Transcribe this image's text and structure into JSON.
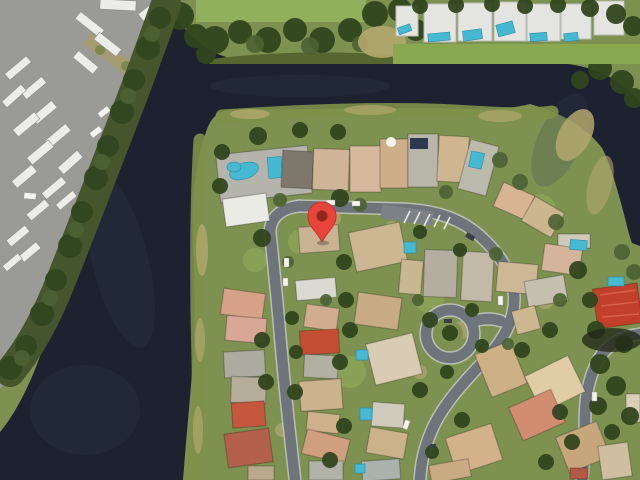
{
  "scene": {
    "type": "satellite-aerial-view",
    "description": "Google-Maps style satellite screenshot of a waterfront residential neighborhood. A dark canal wraps from the lower-left up across the top. A bus/RV parking lot fills the top-left corner, a row of white condo buildings with small pools lines the top-right, and single-family homes with gray, tan and red roofs sit along curving streets with a cul-de-sac loop. A red location pin marks a house near the center.",
    "visible_text": "none"
  },
  "marker": {
    "name": "location-pin",
    "tip_x_pct": 50.2,
    "tip_y_pct": 50.0,
    "body_color": "#e8443b",
    "dot_color": "#8e2a1c"
  },
  "palette": {
    "water": "#1c2230",
    "water_highlight": "#39445c",
    "grass": "#7d9150",
    "grass_bright": "#92b05c",
    "trees_dark": "#32461f",
    "trees_mid": "#4c6233",
    "bank_tan": "#b3a76d",
    "road": "#6e747b",
    "curb": "#c3c7c6",
    "parking_asphalt": "#9a9b97",
    "vehicle_white": "#ecedea",
    "roof_gray": "#b8b5a9",
    "roof_tan": "#cdb18a",
    "roof_red": "#c23f2c",
    "pool": "#45b9d2",
    "condo_white": "#e4e5e1"
  },
  "regions": [
    {
      "name": "parking-lot",
      "label": "bus and RV parking lot"
    },
    {
      "name": "canal-water",
      "label": "dark canal / lake water"
    },
    {
      "name": "tree-line",
      "label": "tree line along water"
    },
    {
      "name": "condo-row",
      "label": "white condo buildings with pools"
    },
    {
      "name": "neighborhood",
      "label": "residential streets and houses"
    },
    {
      "name": "cul-de-sac",
      "label": "cul-de-sac loop"
    },
    {
      "name": "pin-house",
      "label": "house marked by red pin"
    }
  ]
}
